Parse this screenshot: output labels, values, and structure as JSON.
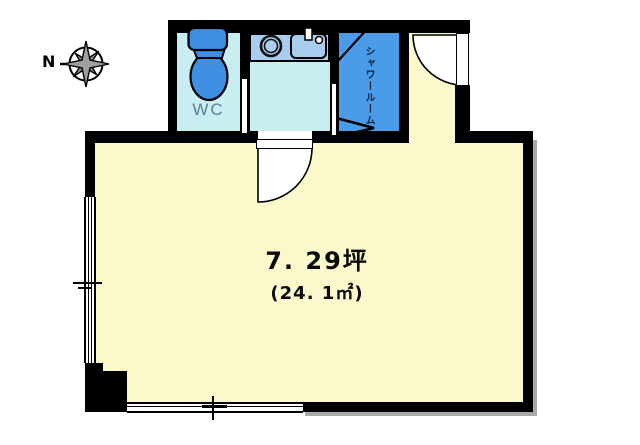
{
  "compass": {
    "north_label": "N"
  },
  "rooms": {
    "wc": {
      "label": "WC"
    },
    "shower": {
      "label": "シャワールーム"
    },
    "main": {
      "area_tsubo": "7. 29坪",
      "area_sqm": "(24. 1㎡)"
    }
  },
  "colors": {
    "wall": "#000000",
    "wet_room_floor": "#c9eef2",
    "kitchen_counter": "#a9cdef",
    "shower_floor": "#4a9be8",
    "fixture_blue": "#3e8ee2",
    "main_floor": "#fbf8cc",
    "wc_label_color": "#5e8192"
  },
  "icons": {
    "compass": "compass-rose-icon",
    "toilet": "toilet-icon",
    "burner": "burner-icon",
    "kitchen_sink": "kitchen-sink-icon",
    "entrance_door": "hinged-door-swing-icon",
    "room_door": "hinged-door-swing-icon",
    "shower_door": "bifold-door-icon"
  }
}
